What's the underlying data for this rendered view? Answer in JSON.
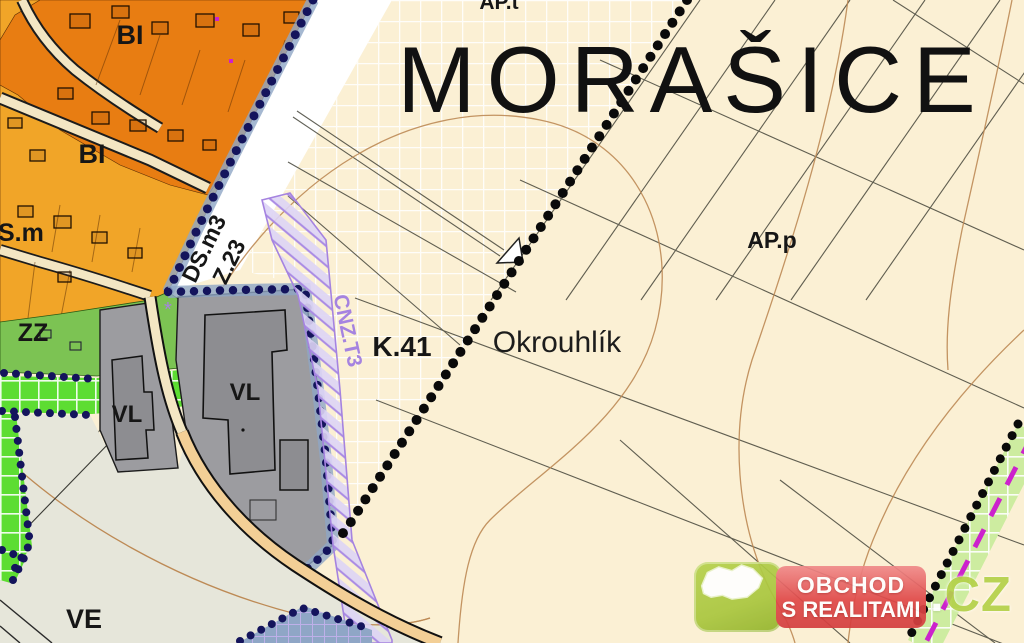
{
  "map": {
    "title": "MORAŠICE",
    "zone_labels": {
      "ap_t": "AP.t",
      "s_m": "S.m",
      "bi_1": "BI",
      "bi_2": "BI",
      "zz": "ZZ",
      "vl_left": "VL",
      "vl_main": "VL",
      "ve": "VE",
      "ap_p": "AP.p",
      "k41": "K.41",
      "okrouhlik": "Okrouhlík",
      "ds_m3": "DS.m3",
      "z23": "Z.23",
      "cnz_t3": "CNZ.T3",
      "asterisk_mark": "*"
    },
    "colors": {
      "cream": "#fbf0d4",
      "orange_dark": "#e87d12",
      "orange_amber": "#f1a528",
      "green_zz": "#7cc353",
      "green_bright": "#5ddd32",
      "green_strip_light": "#cdeca0",
      "gray_vl": "#9c9ca0",
      "gray_building": "#8d8d91",
      "ve_fill": "#e6e6da",
      "contour": "#bd8a55",
      "parcel": "#45453a",
      "purple_hatch": "#a583e0",
      "magenta": "#cc22cc",
      "navy": "#14145c",
      "blue_band": "#8fa6c6",
      "road_cream": "#f3e6c3",
      "road_tan": "#f3cf96",
      "logo_green": "#a9c63e",
      "logo_red": "#e04848"
    }
  },
  "logo": {
    "line1": "OBCHOD",
    "line2": "S REALITAMI",
    "dot": ".",
    "tld": "CZ"
  }
}
